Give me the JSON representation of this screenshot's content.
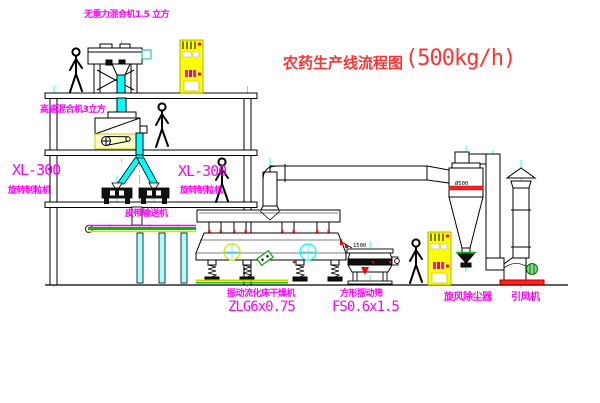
{
  "diagram": {
    "title": {
      "text": "农药生产线流程图",
      "capacity": "(500kg/h)"
    },
    "equipment_labels": {
      "gravity_mixer": "无重力混合机1.5 立方",
      "high_speed_mixer": "高速混合机3立方",
      "granulator_left": {
        "model": "XL-300",
        "name": "旋转制粒机"
      },
      "granulator_right": {
        "model": "XL-300",
        "name": "旋转制粒机"
      },
      "belt_conveyor": "皮带输送机",
      "fluid_bed_dryer": {
        "name": "振动流化床干燥机",
        "model": "ZLG6x0.75"
      },
      "vibrating_sieve": {
        "name": "方形振动筛",
        "model": "FS0.6x1.5"
      },
      "cyclone": "旋风除尘器",
      "induced_fan": "引风机"
    },
    "dimensions": {
      "sieve_length": "1500",
      "cyclone_diameter": "Ø500"
    },
    "colors": {
      "label_magenta": "#ff00ff",
      "title_red": "#ff3333",
      "centerline_cyan": "#00ffff",
      "cabinet_yellow": "#ffff00",
      "line_black": "#000000",
      "belt_green": "#00bb00",
      "base_red": "#ff2222"
    }
  }
}
